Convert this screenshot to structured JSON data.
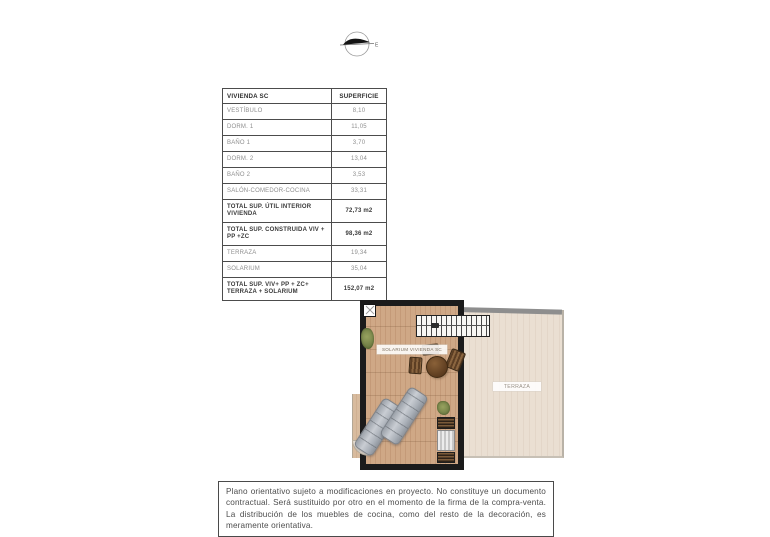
{
  "compass": {
    "direction_label": "E"
  },
  "table": {
    "headers": [
      "VIVIENDA SC",
      "SUPERFICIE"
    ],
    "rows": [
      {
        "label": "VESTÍBULO",
        "value": "8,10"
      },
      {
        "label": "DORM. 1",
        "value": "11,05"
      },
      {
        "label": "BAÑO 1",
        "value": "3,70"
      },
      {
        "label": "DORM. 2",
        "value": "13,04"
      },
      {
        "label": "BAÑO 2",
        "value": "3,53"
      },
      {
        "label": "SALÓN-COMEDOR-COCINA",
        "value": "33,31"
      },
      {
        "label": "TOTAL SUP. ÚTIL INTERIOR VIVIENDA",
        "value": "72,73 m2"
      },
      {
        "label": "TOTAL SUP. CONSTRUIDA VIV + PP +ZC",
        "value": "98,36 m2"
      },
      {
        "label": "TERRAZA",
        "value": "19,34"
      },
      {
        "label": "SOLARIUM",
        "value": "35,04"
      },
      {
        "label": "TOTAL SUP. VIV+ PP + ZC+ TERRAZA + SOLARIUM",
        "value": "152,07 m2"
      }
    ]
  },
  "floorplan": {
    "solarium_label": "SOLARIUM VIVIENDA SC",
    "terrace_label": "TERRAZA",
    "colors": {
      "wall": "#1b1b1b",
      "wood_deck": "#cfa886",
      "terrace_floor": "#eadfd2",
      "terrace_band": "#8e8e8e",
      "plant": "#6b7941",
      "lounger": "#aab0b8"
    }
  },
  "disclaimer": {
    "text": "Plano orientativo sujeto a modificaciones en proyecto. No constituye un documento contractual. Será sustituido por otro en el momento de la firma de la compra-venta. La distribución de los muebles de cocina, como del resto de la decoración, es meramente orientativa."
  }
}
